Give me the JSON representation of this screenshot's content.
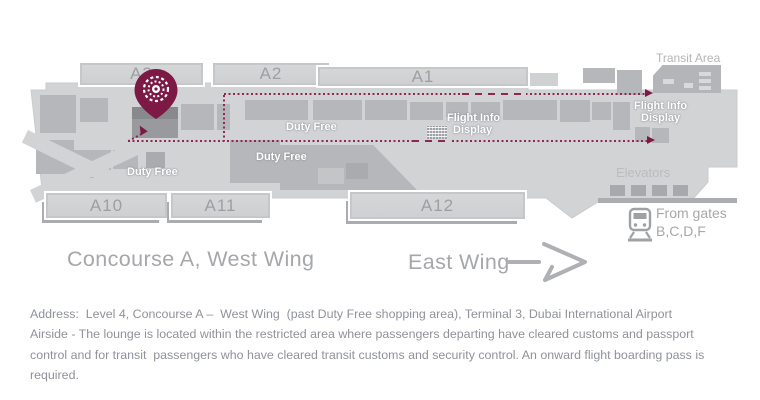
{
  "colors": {
    "floor": "#d2d3d5",
    "shop_block": "#b5b7ba",
    "pier": "#d0d2d4",
    "lounge_block": "#8e9094",
    "route": "#8d2950",
    "pin": "#7c1a45",
    "gate_label": "#9da0a3",
    "title_text": "#a5a7aa",
    "body_text": "#8f929a",
    "white_label": "#ffffff"
  },
  "map": {
    "top_gates": [
      "A3",
      "A2",
      "A1"
    ],
    "bottom_gates": [
      "A10",
      "A11",
      "A12"
    ],
    "transit_area_label": "Transit Area",
    "elevators_label": "Elevators",
    "duty_free_labels": [
      "Duty Free",
      "Duty Free",
      "Duty Free"
    ],
    "flight_info_display": {
      "line1": "Flight Info",
      "line2": "Display"
    }
  },
  "wings": {
    "west": "Concourse A, West Wing",
    "east": "East Wing"
  },
  "transport_note": {
    "line1": "From gates",
    "line2": "B,C,D,F"
  },
  "address": {
    "lines": [
      "Address:  Level 4, Concourse A –  West Wing  (past Duty Free shopping area), Terminal 3, Dubai International Airport",
      "Airside - The lounge is located within the restricted area where passengers departing have cleared customs and passport",
      "control and for transit  passengers who have cleared transit customs and security control. An onward flight boarding pass is",
      "required."
    ]
  },
  "icons": {
    "pin": "location-pin",
    "train": "train",
    "east_arrow": "arrow-right",
    "fids": "flight-info-board"
  }
}
